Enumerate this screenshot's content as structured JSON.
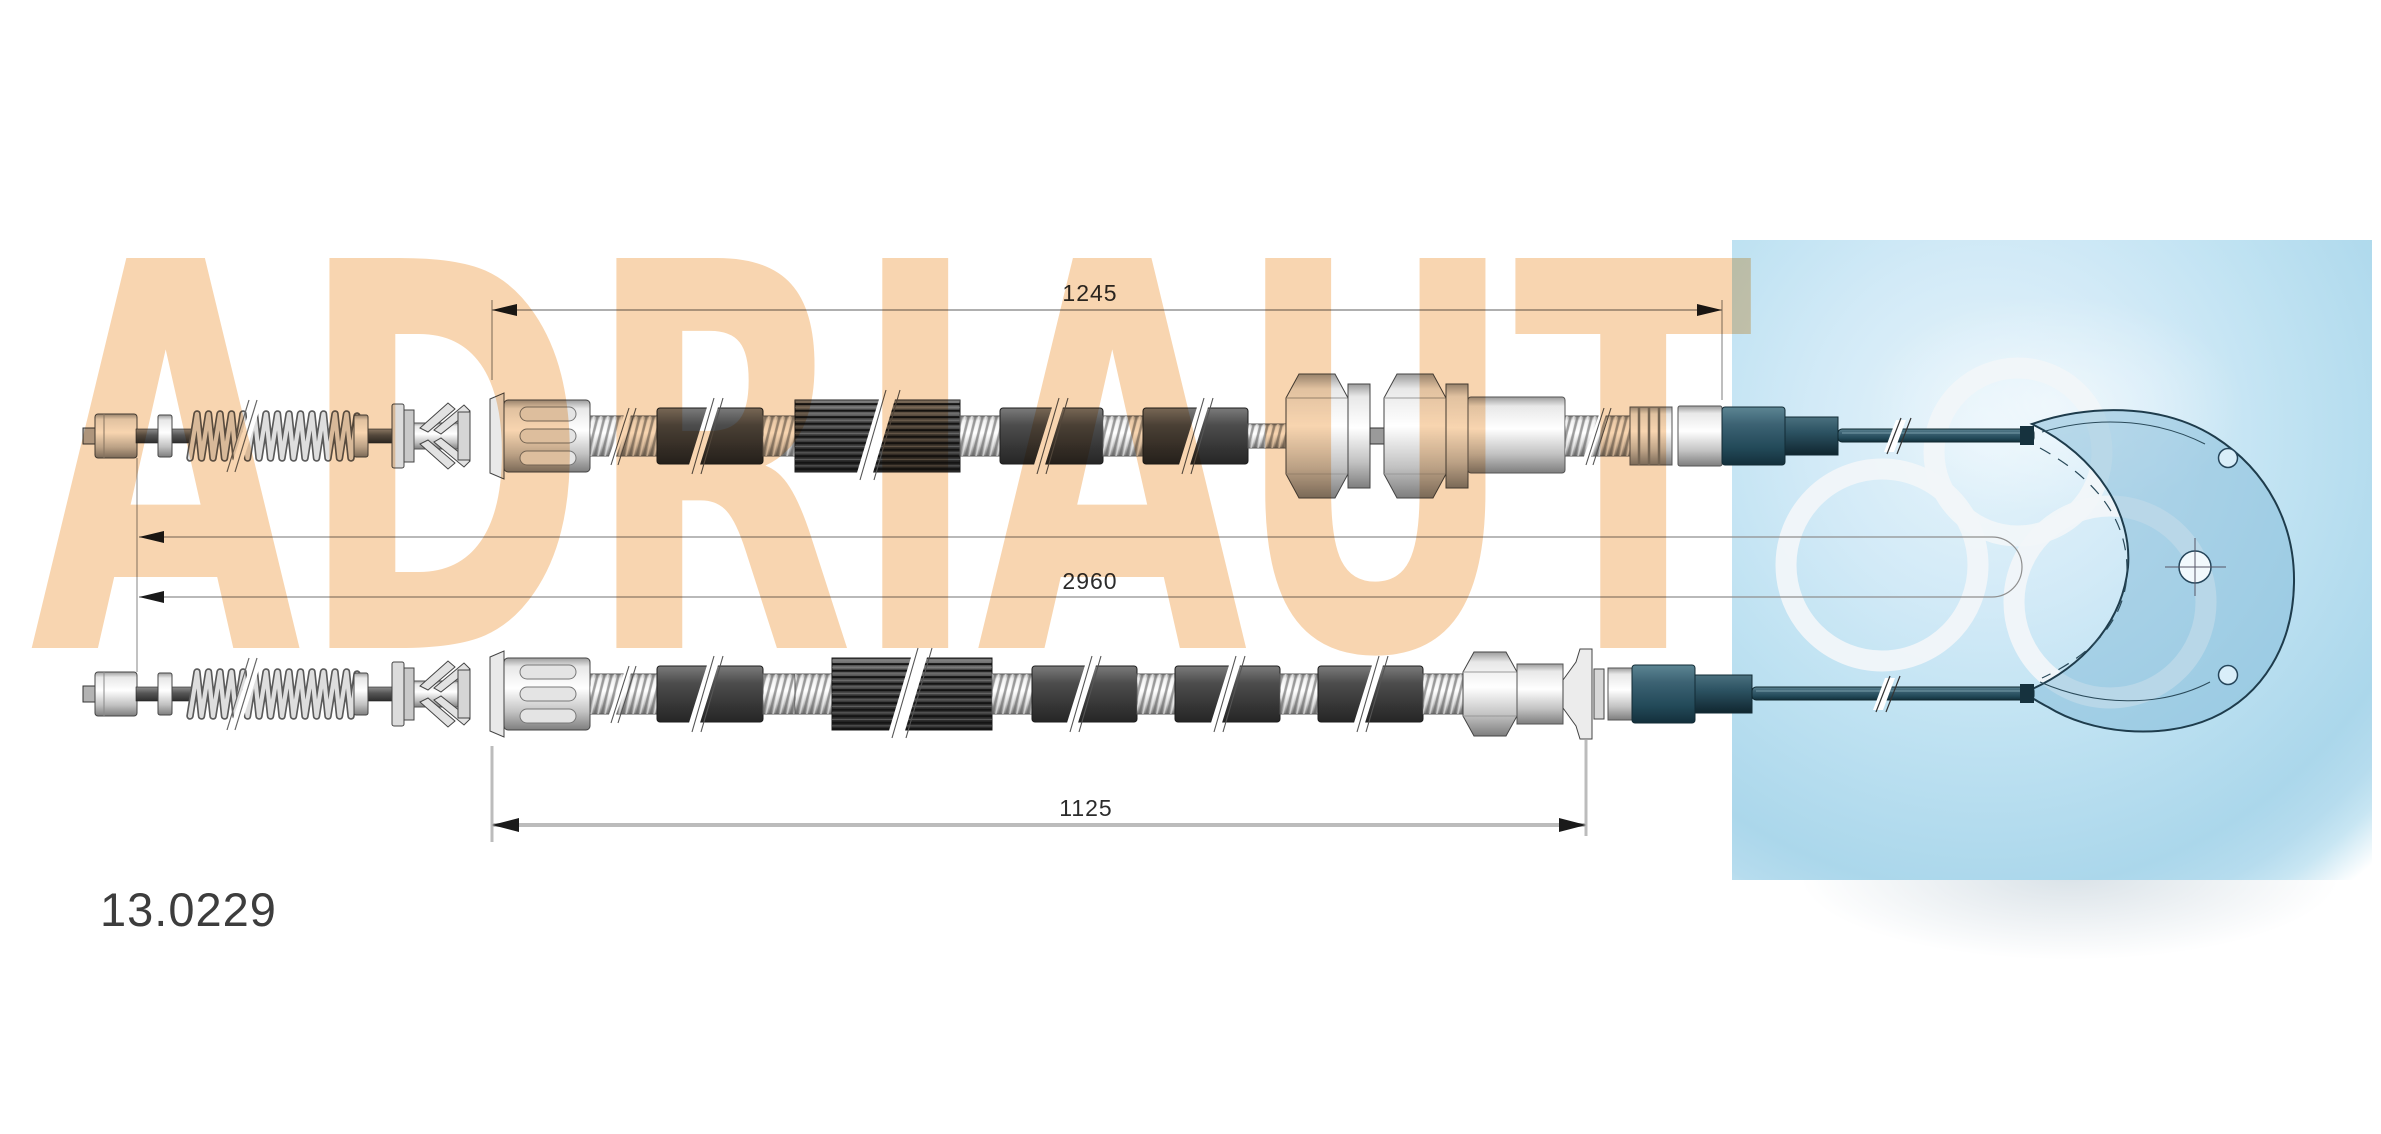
{
  "drawing": {
    "part_number": "13.0229",
    "watermark_text": "ADRIAUT",
    "dimension_upper": "1245",
    "dimension_total": "2960",
    "dimension_lower": "1125",
    "colors": {
      "watermark_peach": "#f8d3ab",
      "logo_blue": "#c3e2f2",
      "cable_teal": "#1f3e4b",
      "dimension_gray": "#8f8f8f"
    }
  }
}
